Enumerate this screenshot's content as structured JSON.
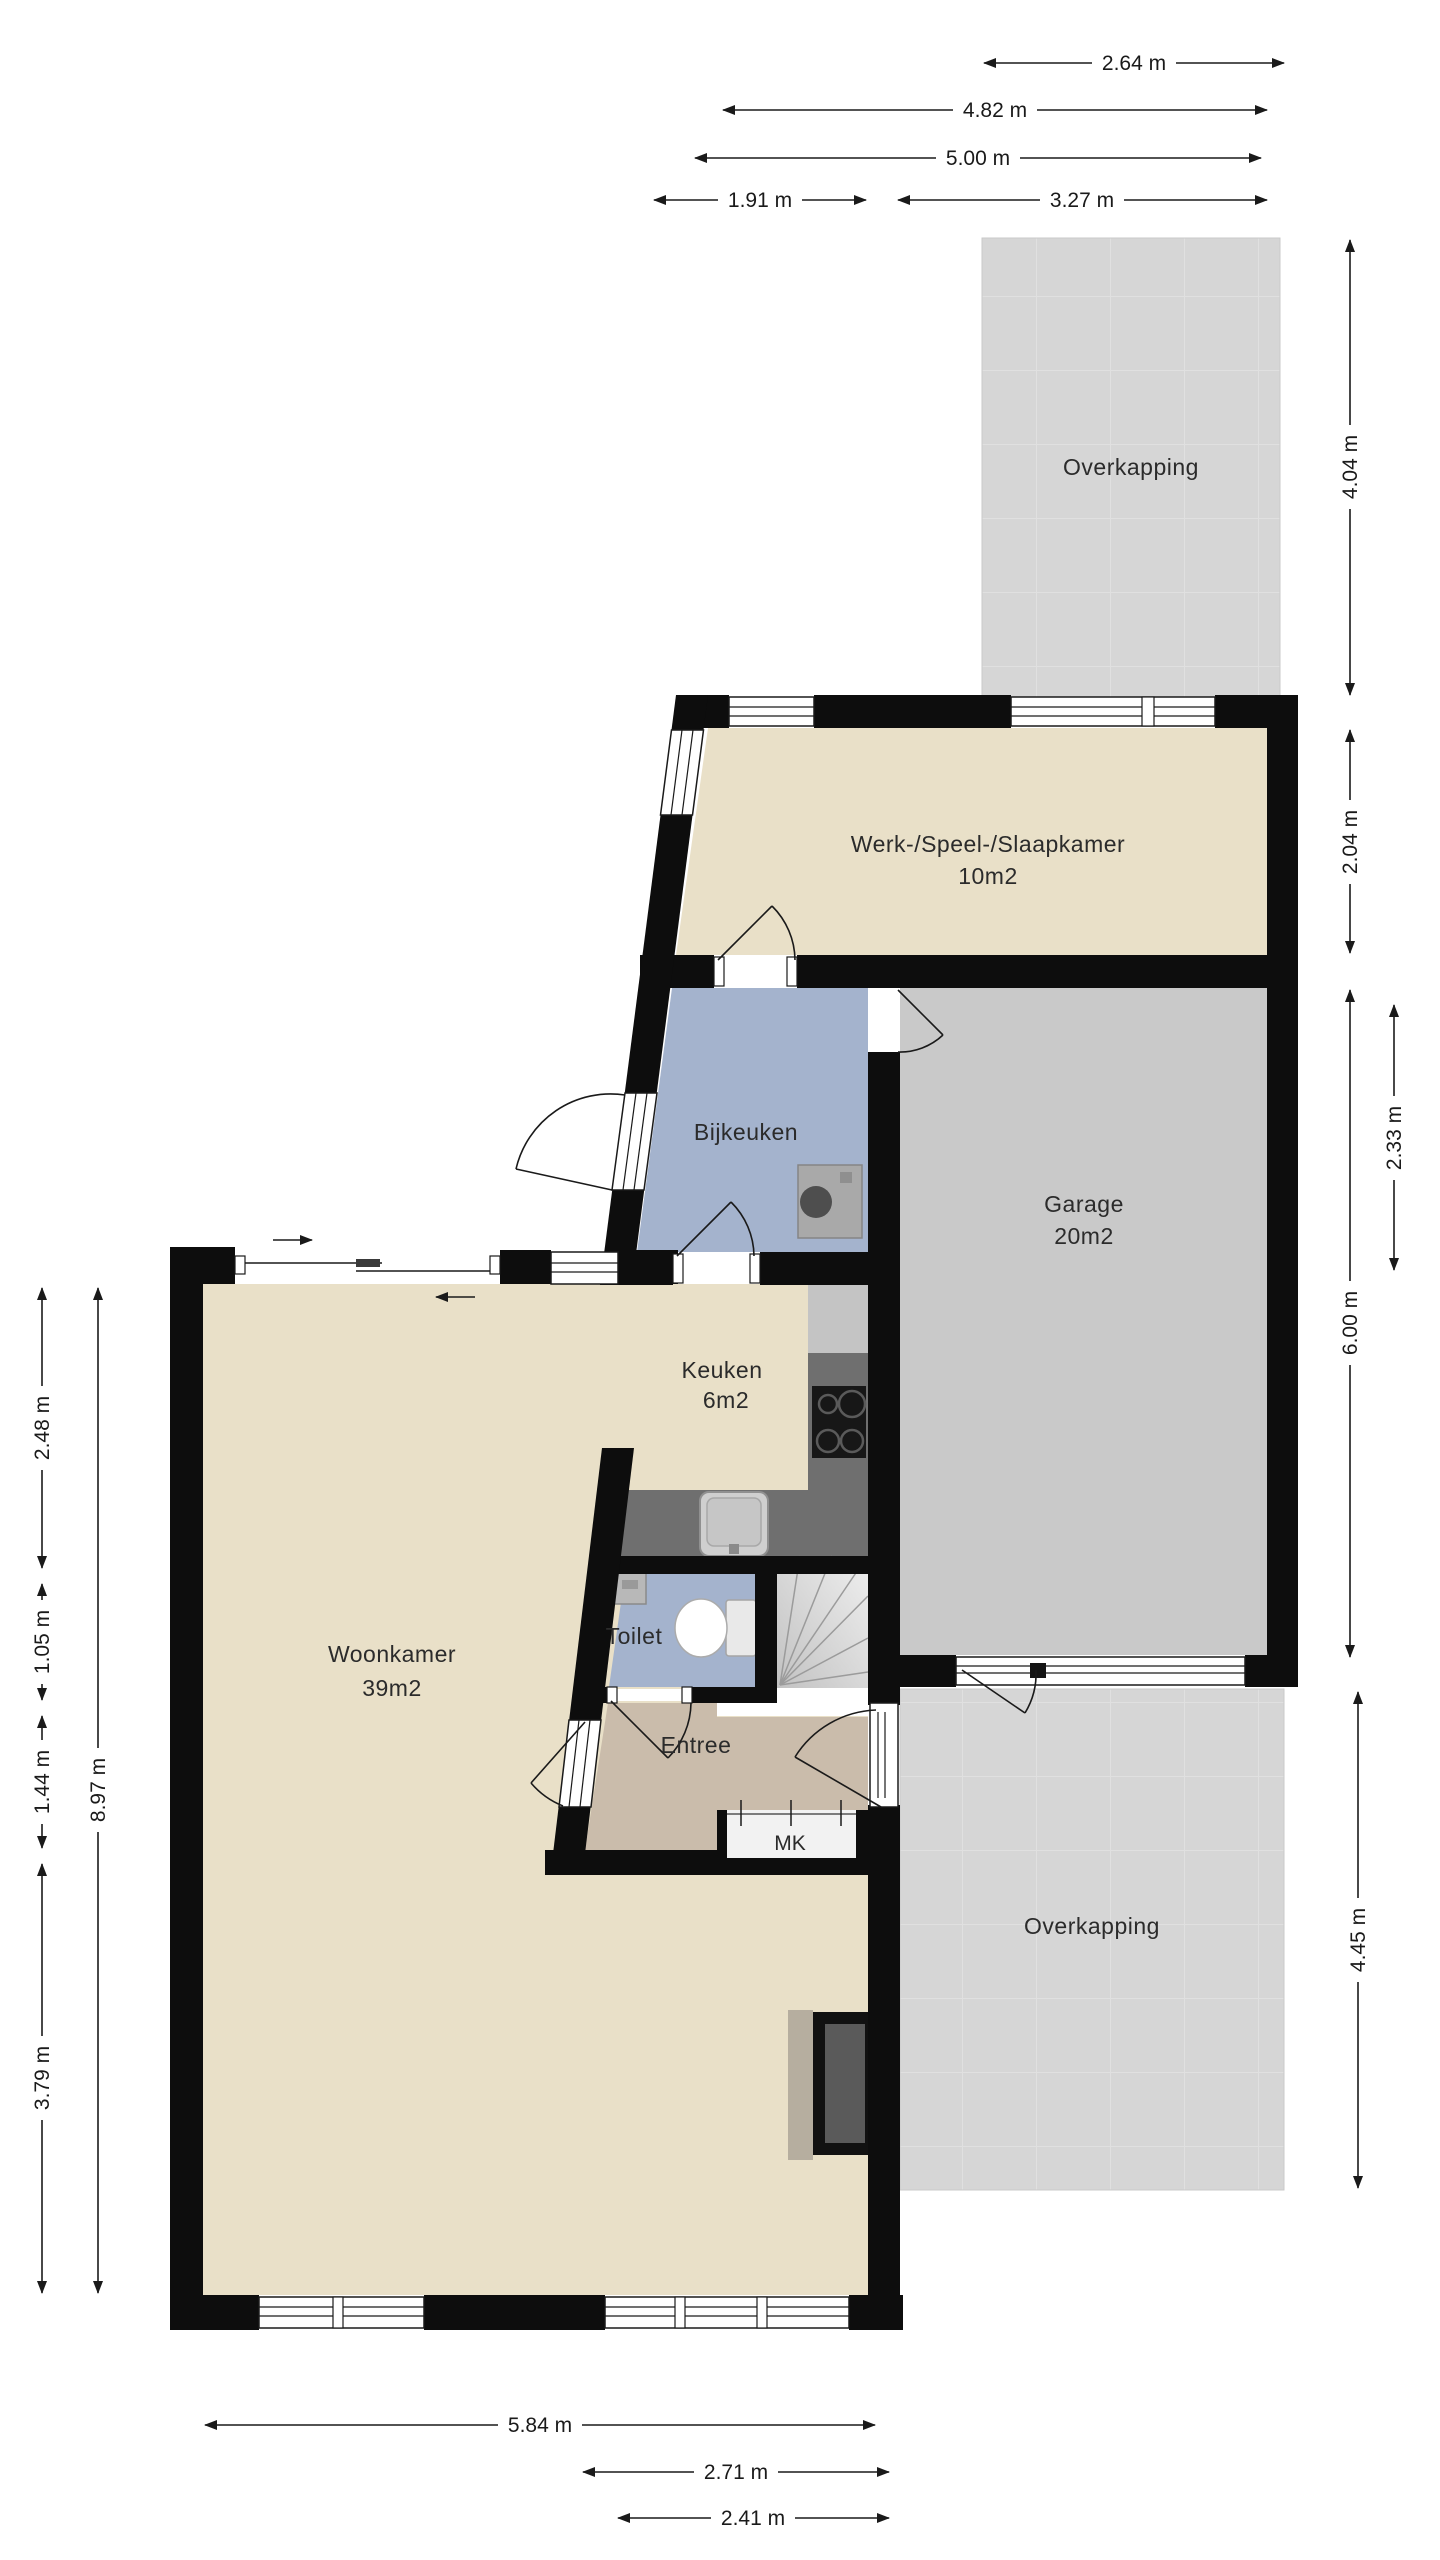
{
  "title": "Floor plan ground floor",
  "rooms": {
    "overkapping_top": "Overkapping",
    "werk": "Werk-/Speel-/Slaapkamer",
    "werk_area": "10m2",
    "bijkeuken": "Bijkeuken",
    "garage": "Garage",
    "garage_area": "20m2",
    "keuken": "Keuken",
    "keuken_area": "6m2",
    "toilet": "Toilet",
    "entree": "Entree",
    "mk": "MK",
    "woonkamer": "Woonkamer",
    "woonkamer_area": "39m2",
    "overkapping_bottom": "Overkapping"
  },
  "dimensions": {
    "top": [
      "2.64 m",
      "4.82 m",
      "5.00 m",
      "1.91 m",
      "3.27 m"
    ],
    "right": [
      "4.04 m",
      "2.04 m",
      "6.00 m",
      "2.33 m",
      "4.45 m"
    ],
    "left": [
      "2.48 m",
      "1.05 m",
      "1.44 m",
      "3.79 m",
      "8.97 m"
    ],
    "bottom": [
      "5.84 m",
      "2.71 m",
      "2.41 m"
    ]
  },
  "colors": {
    "wall": "#0d0d0d",
    "floor_beige": "#e9e0c8",
    "floor_blue": "#a4b3cd",
    "floor_tan": "#cabcab",
    "floor_gray": "#c9c9c9",
    "overkapping_gray": "#d6d6d6",
    "counter_gray": "#6f6f6f",
    "dim_line": "#1a1a1a"
  }
}
